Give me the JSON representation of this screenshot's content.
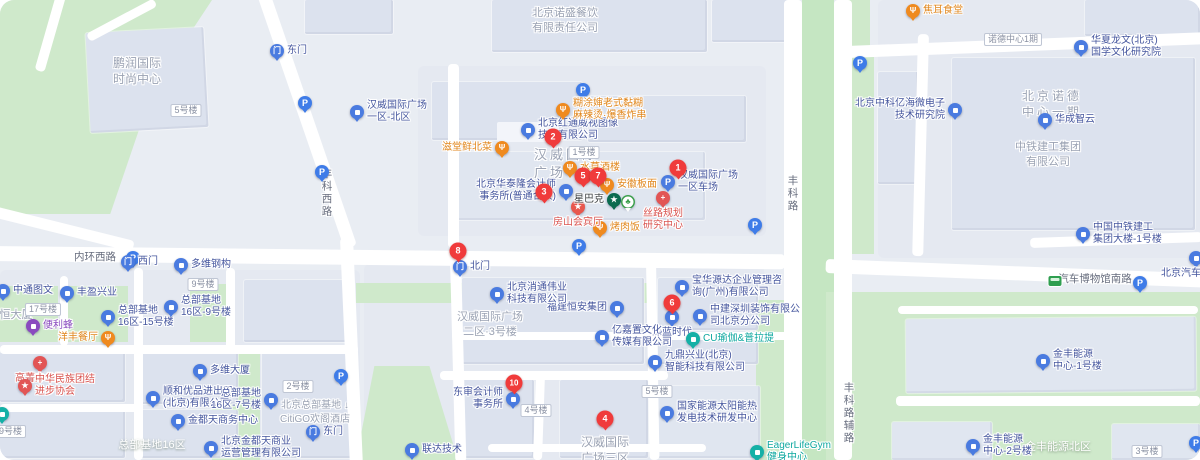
{
  "colors": {
    "red_pin": "#f03b3b",
    "company_blue": "#4a7be0",
    "company_text": "#45569e",
    "food_orange": "#ef8a1f",
    "teal": "#14b0a6",
    "purple": "#8a4bbf",
    "red_poi": "#e25555",
    "cafe_green": "#0b6b4f",
    "parking_blue": "#3f7ce8",
    "green_area": "#cfe9cb",
    "median_green": "#c5e6c2",
    "building_fill": "#dce2ee",
    "map_bg": "#e9edf3",
    "area_label": "#9aa2b3"
  },
  "markers": [
    {
      "num": "1",
      "x": 678,
      "y": 168
    },
    {
      "num": "2",
      "x": 553,
      "y": 137
    },
    {
      "num": "3",
      "x": 544,
      "y": 192
    },
    {
      "num": "4",
      "x": 605,
      "y": 419
    },
    {
      "num": "5",
      "x": 583,
      "y": 176
    },
    {
      "num": "6",
      "x": 672,
      "y": 303
    },
    {
      "num": "7",
      "x": 598,
      "y": 176
    },
    {
      "num": "8",
      "x": 458,
      "y": 251
    },
    {
      "num": "10",
      "x": 514,
      "y": 383
    }
  ],
  "pois": [
    {
      "type": "company",
      "lines": [
        "汉威国际广场",
        "一区-北区"
      ],
      "x": 357,
      "y": 112,
      "side": "right"
    },
    {
      "type": "company",
      "lines": [
        "北京红通威视图像",
        "技术有限公司"
      ],
      "x": 528,
      "y": 130,
      "side": "right"
    },
    {
      "type": "company",
      "lines": [
        "北京华泰隆会计师",
        "事务所(普通合伙)"
      ],
      "x": 566,
      "y": 191,
      "side": "left"
    },
    {
      "type": "company",
      "lines": [
        "宝华源达企业管理咨",
        "询(广州)有限公司"
      ],
      "x": 682,
      "y": 287,
      "side": "right"
    },
    {
      "type": "company",
      "lines": [
        "深蓝时代"
      ],
      "x": 672,
      "y": 317,
      "side": "below"
    },
    {
      "type": "company",
      "lines": [
        "中建深圳装饰有限公",
        "司北京分公司"
      ],
      "x": 700,
      "y": 316,
      "side": "right"
    },
    {
      "type": "company",
      "lines": [
        "福建恒安集团"
      ],
      "x": 617,
      "y": 308,
      "side": "left"
    },
    {
      "type": "company",
      "lines": [
        "亿嘉置文化",
        "传媒有限公司"
      ],
      "x": 602,
      "y": 337,
      "side": "right"
    },
    {
      "type": "company",
      "lines": [
        "九鼎兴业(北京)",
        "智能科技有限公司"
      ],
      "x": 655,
      "y": 362,
      "side": "right"
    },
    {
      "type": "company",
      "lines": [
        "北京消通伟业",
        "科技有限公司"
      ],
      "x": 497,
      "y": 294,
      "side": "right"
    },
    {
      "type": "company",
      "lines": [
        "东审会计师",
        "事务所"
      ],
      "x": 513,
      "y": 399,
      "side": "left"
    },
    {
      "type": "company",
      "lines": [
        "国家能源太阳能热",
        "发电技术研发中心"
      ],
      "x": 667,
      "y": 413,
      "side": "right"
    },
    {
      "type": "company",
      "lines": [
        "顺和优品进出口",
        "(北京)有限公司"
      ],
      "x": 153,
      "y": 398,
      "side": "right"
    },
    {
      "type": "company",
      "lines": [
        "多维大厦"
      ],
      "x": 200,
      "y": 371,
      "side": "right"
    },
    {
      "type": "company",
      "lines": [
        "多维钢构"
      ],
      "x": 181,
      "y": 265,
      "side": "right"
    },
    {
      "type": "company",
      "lines": [
        "金都天商务中心"
      ],
      "x": 178,
      "y": 421,
      "side": "right"
    },
    {
      "type": "company",
      "lines": [
        "北京金都天商业",
        "运营管理有限公司"
      ],
      "x": 211,
      "y": 448,
      "side": "right"
    },
    {
      "type": "company",
      "lines": [
        "总部基地",
        "16区-15号楼"
      ],
      "x": 108,
      "y": 317,
      "side": "right"
    },
    {
      "type": "company",
      "lines": [
        "总部基地",
        "16区-9号楼"
      ],
      "x": 171,
      "y": 307,
      "side": "right"
    },
    {
      "type": "company",
      "lines": [
        "总部基地",
        "16区-7号楼"
      ],
      "x": 271,
      "y": 400,
      "side": "left"
    },
    {
      "type": "company",
      "lines": [
        "丰盈兴业"
      ],
      "x": 67,
      "y": 293,
      "side": "right"
    },
    {
      "type": "company",
      "lines": [
        "中通图文"
      ],
      "x": 3,
      "y": 291,
      "side": "right"
    },
    {
      "type": "company",
      "lines": [
        "华夏龙文(北京)",
        "国学文化研究院"
      ],
      "x": 1081,
      "y": 47,
      "side": "right"
    },
    {
      "type": "company",
      "lines": [
        "北京中科亿海微电子",
        "技术研究院"
      ],
      "x": 955,
      "y": 110,
      "side": "left"
    },
    {
      "type": "company",
      "lines": [
        "华成智云"
      ],
      "x": 1045,
      "y": 120,
      "side": "right"
    },
    {
      "type": "company",
      "lines": [
        "中国中铁建工",
        "集团大楼-1号楼"
      ],
      "x": 1083,
      "y": 234,
      "side": "right"
    },
    {
      "type": "company",
      "lines": [
        "金丰能源",
        "中心-1号楼"
      ],
      "x": 1043,
      "y": 361,
      "side": "right"
    },
    {
      "type": "company",
      "lines": [
        "金丰能源",
        "中心-2号楼"
      ],
      "x": 973,
      "y": 446,
      "side": "right"
    },
    {
      "type": "company",
      "lines": [
        "联达技术"
      ],
      "x": 412,
      "y": 450,
      "side": "right"
    },
    {
      "type": "company",
      "lines": [
        "北京汽车博物馆"
      ],
      "x": 1196,
      "y": 258,
      "side": "below"
    },
    {
      "type": "parkinglot",
      "lines": [
        "汉威国际广场",
        "一区车场"
      ],
      "x": 668,
      "y": 182,
      "side": "right"
    },
    {
      "type": "gate",
      "lines": [
        "东门"
      ],
      "x": 277,
      "y": 51,
      "side": "right"
    },
    {
      "type": "gate",
      "lines": [
        "西门"
      ],
      "x": 128,
      "y": 262,
      "side": "right"
    },
    {
      "type": "gate",
      "lines": [
        "北门"
      ],
      "x": 460,
      "y": 267,
      "side": "right"
    },
    {
      "type": "gate",
      "lines": [
        "东门"
      ],
      "x": 313,
      "y": 432,
      "side": "right"
    },
    {
      "type": "food",
      "lines": [
        "糊涂婶老式黏糊",
        "麻辣烫·爆香炸串"
      ],
      "x": 563,
      "y": 110,
      "side": "right"
    },
    {
      "type": "food",
      "lines": [
        "滋堂鲜北菜"
      ],
      "x": 502,
      "y": 148,
      "side": "left"
    },
    {
      "type": "food",
      "lines": [
        "水草酒楼"
      ],
      "x": 570,
      "y": 168,
      "side": "right"
    },
    {
      "type": "food",
      "lines": [
        "安徽板面"
      ],
      "x": 607,
      "y": 185,
      "side": "right"
    },
    {
      "type": "food",
      "lines": [
        "烤肉饭"
      ],
      "x": 600,
      "y": 228,
      "side": "right"
    },
    {
      "type": "food",
      "lines": [
        "洋丰餐厅"
      ],
      "x": 108,
      "y": 338,
      "side": "left"
    },
    {
      "type": "food",
      "lines": [
        "焦耳食堂"
      ],
      "x": 913,
      "y": 11,
      "side": "right"
    },
    {
      "type": "life",
      "lines": [
        "CU瑜伽&普拉提"
      ],
      "x": 693,
      "y": 339,
      "side": "right"
    },
    {
      "type": "life",
      "lines": [
        "EagerLifeGym",
        "健身中心"
      ],
      "x": 757,
      "y": 452,
      "side": "right"
    },
    {
      "type": "life",
      "lines": [],
      "x": 2,
      "y": 414,
      "side": "right"
    },
    {
      "type": "store",
      "lines": [
        "便利蜂"
      ],
      "x": 33,
      "y": 326,
      "side": "right"
    },
    {
      "type": "medical",
      "lines": [
        "丝路规划",
        "研究中心"
      ],
      "x": 663,
      "y": 198,
      "side": "below"
    },
    {
      "type": "medical",
      "lines": [
        "高菁办公区"
      ],
      "x": 40,
      "y": 363,
      "side": "below"
    },
    {
      "type": "scenic",
      "lines": [
        "房山会宾厅"
      ],
      "x": 578,
      "y": 207,
      "side": "below"
    },
    {
      "type": "assoc",
      "lines": [
        "中华民族团结",
        "进步协会"
      ],
      "x": 25,
      "y": 386,
      "side": "right"
    },
    {
      "type": "cafe",
      "lines": [
        "星巴克"
      ],
      "x": 614,
      "y": 200,
      "side": "left"
    },
    {
      "type": "park",
      "lines": [],
      "x": 628,
      "y": 202,
      "side": "right"
    }
  ],
  "parking": [
    {
      "x": 305,
      "y": 103
    },
    {
      "x": 322,
      "y": 172
    },
    {
      "x": 583,
      "y": 90
    },
    {
      "x": 133,
      "y": 258
    },
    {
      "x": 579,
      "y": 246
    },
    {
      "x": 341,
      "y": 376
    },
    {
      "x": 755,
      "y": 225
    },
    {
      "x": 860,
      "y": 63
    },
    {
      "x": 1140,
      "y": 283
    },
    {
      "x": 1196,
      "y": 443
    }
  ],
  "bus_stops": [
    {
      "x": 1055,
      "y": 281
    }
  ],
  "area_labels": [
    {
      "lines": [
        "鹏润国际",
        "时尚中心"
      ],
      "x": 137,
      "y": 55,
      "cls": "grey",
      "size": 12
    },
    {
      "lines": [
        "北京诺盛餐饮",
        "有限责任公司"
      ],
      "x": 565,
      "y": 6,
      "cls": "grey",
      "size": 11
    },
    {
      "lines": [
        "汉威国际",
        "广场一区"
      ],
      "x": 566,
      "y": 146,
      "cls": "grey-lg",
      "size": 13
    },
    {
      "lines": [
        "北京诺德",
        "中心一期"
      ],
      "x": 1052,
      "y": 88,
      "cls": "grey-lg",
      "size": 12
    },
    {
      "lines": [
        "中铁建工集团",
        "有限公司"
      ],
      "x": 1048,
      "y": 140,
      "cls": "grey",
      "size": 11
    },
    {
      "lines": [
        "汉威国际广场",
        "二区·3号楼"
      ],
      "x": 490,
      "y": 310,
      "cls": "grey",
      "size": 11
    },
    {
      "lines": [
        "汉威国际",
        "广场三区"
      ],
      "x": 605,
      "y": 434,
      "cls": "grey",
      "size": 12
    },
    {
      "lines": [
        "北京总部基地 ↓",
        "CitiGO欢阁酒店"
      ],
      "x": 315,
      "y": 399,
      "cls": "grey",
      "size": 10
    },
    {
      "lines": [
        "恒大厦"
      ],
      "x": 16,
      "y": 308,
      "cls": "grey",
      "size": 11
    },
    {
      "lines": [
        "总部基地16区"
      ],
      "x": 152,
      "y": 438,
      "cls": "white",
      "size": 11
    },
    {
      "lines": [
        "金丰能源北区"
      ],
      "x": 1058,
      "y": 440,
      "cls": "white",
      "size": 11
    }
  ],
  "road_labels": [
    {
      "text": "内环西路",
      "x": 95,
      "y": 249,
      "vertical": false
    },
    {
      "text": "丰科西路",
      "x": 327,
      "y": 168,
      "vertical": true
    },
    {
      "text": "丰科路",
      "x": 793,
      "y": 175,
      "vertical": true
    },
    {
      "text": "丰科路辅路",
      "x": 849,
      "y": 382,
      "vertical": true
    },
    {
      "text": "汽车博物馆南路",
      "x": 1095,
      "y": 271,
      "vertical": false
    }
  ],
  "building_labels": [
    {
      "text": "1号楼",
      "x": 584,
      "y": 146
    },
    {
      "text": "5号楼",
      "x": 186,
      "y": 104
    },
    {
      "text": "9号楼",
      "x": 203,
      "y": 278
    },
    {
      "text": "17号楼",
      "x": 43,
      "y": 303
    },
    {
      "text": "19号楼",
      "x": 8,
      "y": 425
    },
    {
      "text": "2号楼",
      "x": 298,
      "y": 380
    },
    {
      "text": "4号楼",
      "x": 536,
      "y": 404
    },
    {
      "text": "5号楼",
      "x": 657,
      "y": 385
    },
    {
      "text": "3号楼",
      "x": 1147,
      "y": 445
    },
    {
      "text": "诺德中心1期",
      "x": 1013,
      "y": 33
    }
  ]
}
